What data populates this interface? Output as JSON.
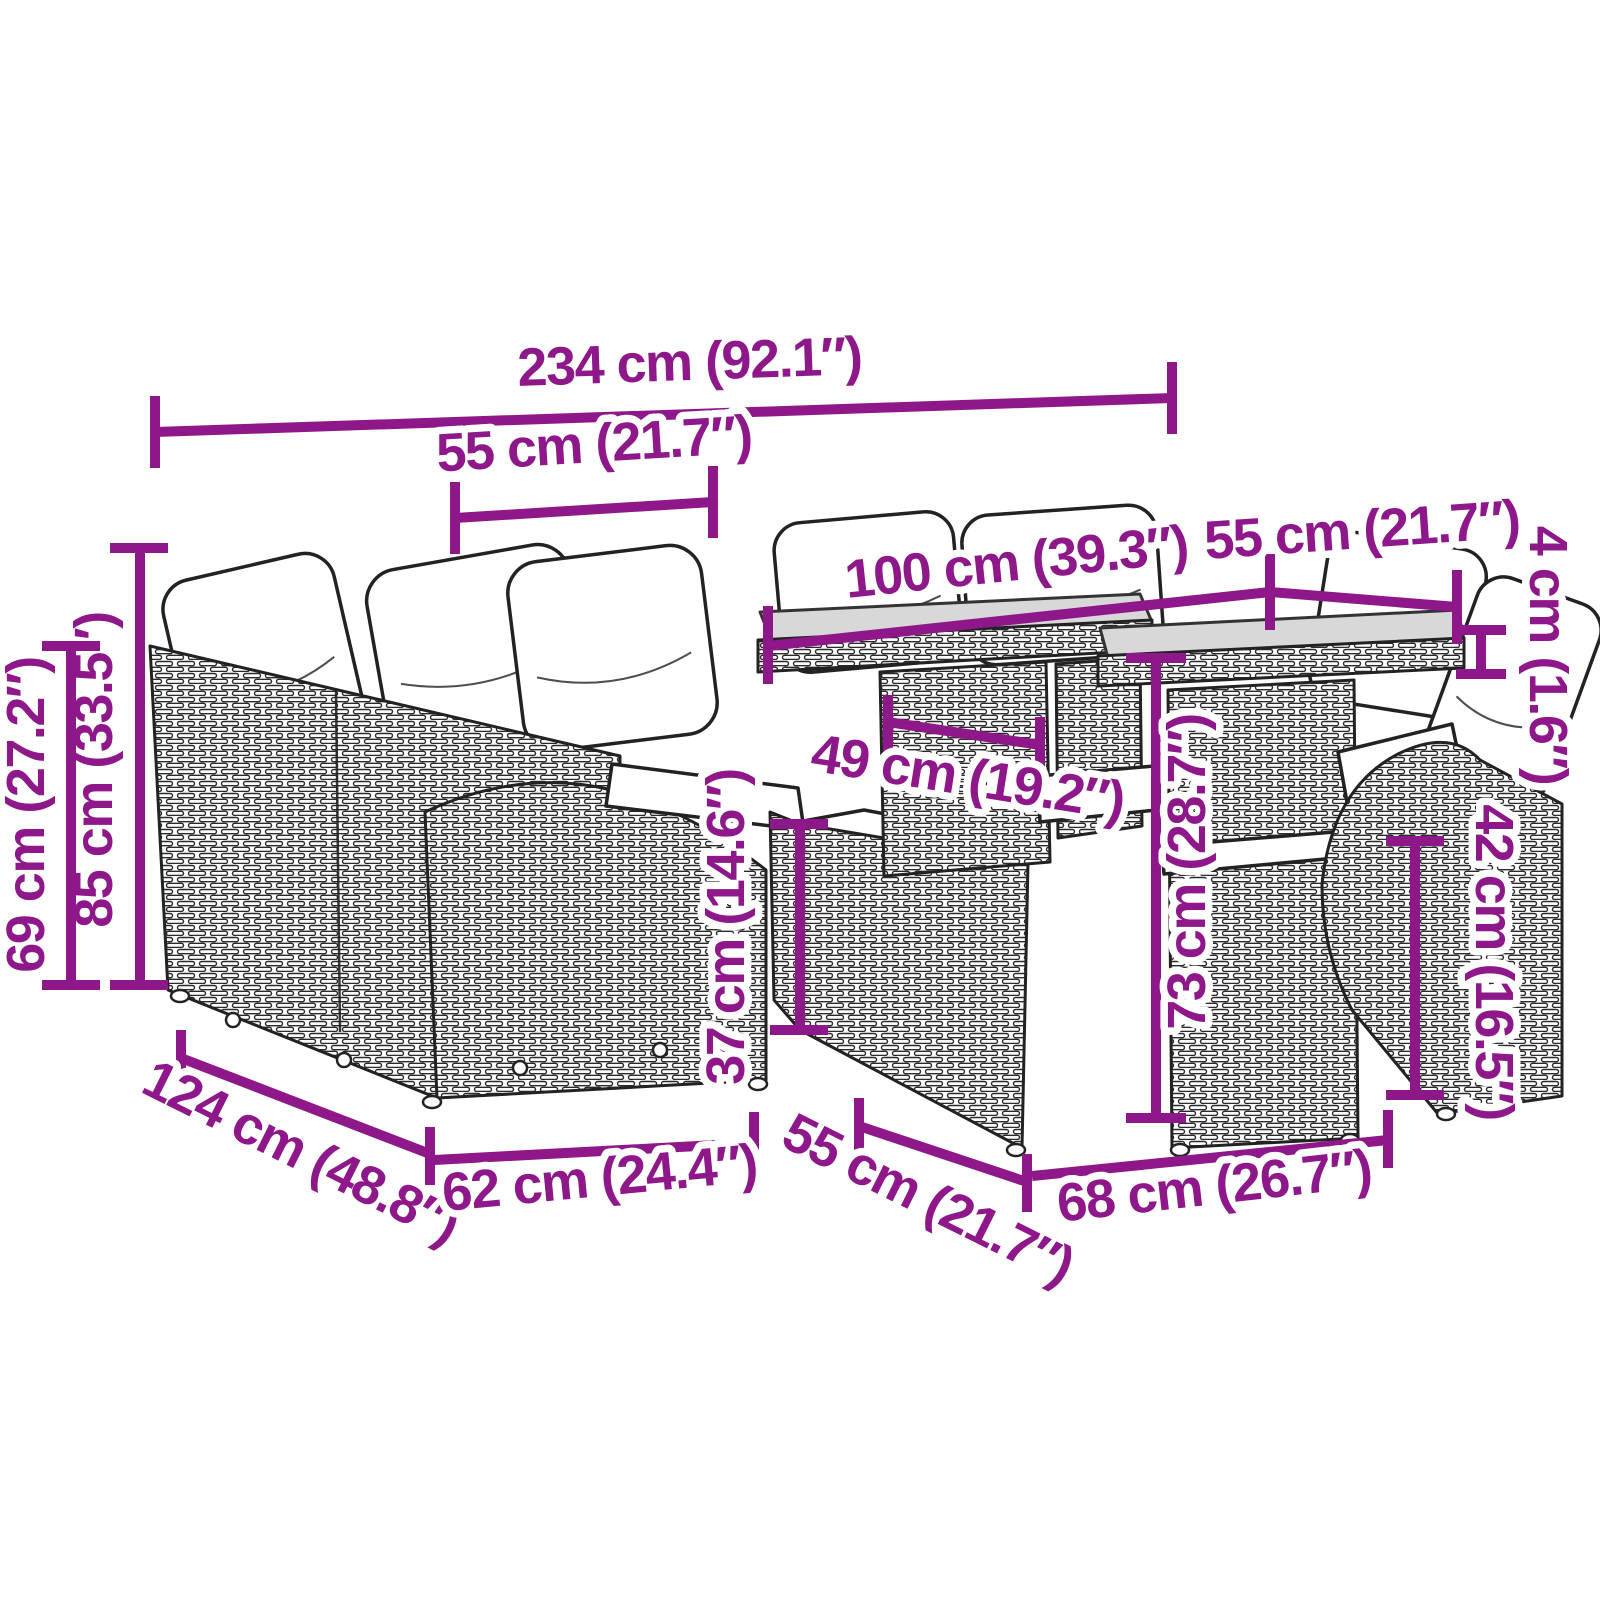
{
  "title": "Garden rattan lounge set with glass-top tables — dimension diagram",
  "colors": {
    "accent": "#8E188A",
    "line_art": "#222222",
    "glass": "#D8D8D8"
  },
  "dimensions": [
    {
      "id": "overall-width",
      "label": "234 cm (92.1″)"
    },
    {
      "id": "back-section-width",
      "label": "55 cm (21.7″)"
    },
    {
      "id": "table-top-width",
      "label": "100 cm (39.3″)"
    },
    {
      "id": "side-table-top-width",
      "label": "55 cm (21.7″)"
    },
    {
      "id": "glass-top-thickness",
      "label": "4 cm (1.6″)"
    },
    {
      "id": "backrest-height",
      "label": "85 cm (33.5″)"
    },
    {
      "id": "arm-height",
      "label": "69 cm (27.2″)"
    },
    {
      "id": "seat-height",
      "label": "37 cm (14.6″)"
    },
    {
      "id": "table-leg-spacing",
      "label": "49 cm (19.2″)"
    },
    {
      "id": "table-height",
      "label": "73 cm (28.7″)"
    },
    {
      "id": "right-arm-height",
      "label": "42 cm (16.5″)"
    },
    {
      "id": "sofa-depth",
      "label": "124 cm (48.8″)"
    },
    {
      "id": "seat-section-width",
      "label": "62 cm (24.4″)"
    },
    {
      "id": "ottoman-width",
      "label": "55 cm (21.7″)"
    },
    {
      "id": "table-front-width",
      "label": "68 cm (26.7″)"
    }
  ]
}
